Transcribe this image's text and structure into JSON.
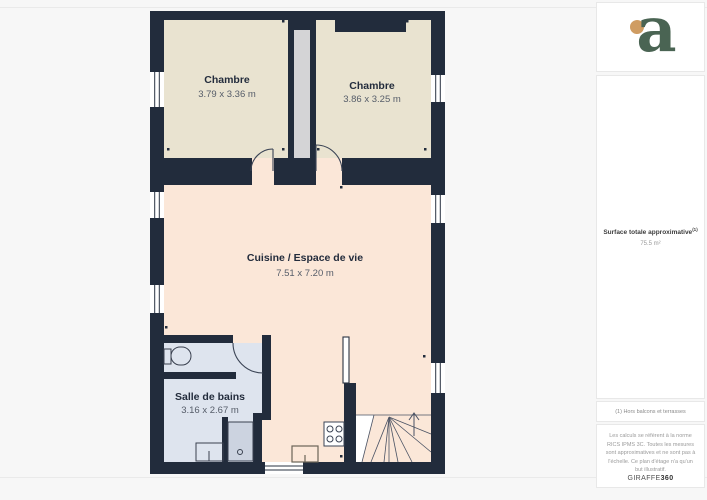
{
  "floor_plan": {
    "rooms": [
      {
        "name": "Chambre",
        "dimensions": "3.79 x 3.36 m"
      },
      {
        "name": "Chambre",
        "dimensions": "3.86 x 3.25 m"
      },
      {
        "name": "Cuisine / Espace de vie",
        "dimensions": "7.51 x 7.20 m"
      },
      {
        "name": "Salle de bains",
        "dimensions": "3.16 x 2.67 m"
      }
    ],
    "fixtures": [
      "toilet",
      "bathroom-sink",
      "shower",
      "stove",
      "kitchen-sink",
      "staircase",
      "duct-shaft",
      "windows",
      "doors"
    ],
    "colors": {
      "wall": "#222c3c",
      "bedroom_floor": "#e9e3d0",
      "living_floor": "#fbe7d8",
      "bathroom_floor": "#dee4ee",
      "shaft": "#d4d4d6",
      "background": "#f7f7f7"
    }
  },
  "sidebar": {
    "logo_letter": "a",
    "logo_green": "#4a6453",
    "logo_dot_color": "#cf9c62",
    "surface_label": "Surface totale approximative",
    "surface_note_ref": "(1)",
    "surface_value": "75.5 m²",
    "footnote": "(1) Hors balcons et terrasses",
    "legal": "Les calculs se réfèrent à la norme RICS IPMS 3C. Toutes les mesures sont approximatives et ne sont pas à l'échelle. Ce plan d'étage n'a qu'un but illustratif.",
    "brand": "GIRAFFE",
    "brand_suffix": "360"
  }
}
